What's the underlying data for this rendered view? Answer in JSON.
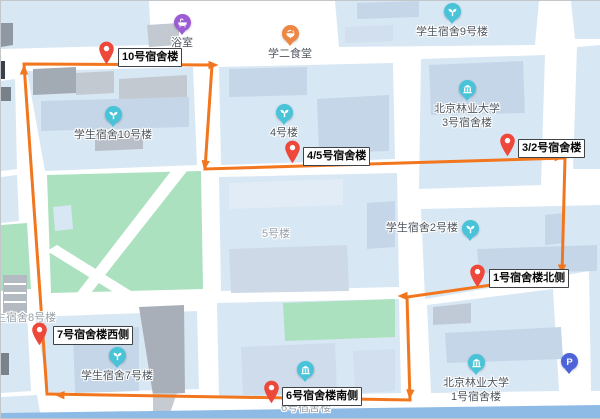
{
  "app": {
    "view": "campus-route-map"
  },
  "colors": {
    "route_orange": "#F2761D",
    "pin_red": "#EE483B",
    "poi_teal": "#49C3D7",
    "poi_purple": "#9C5CD4",
    "poi_orange": "#EE8742",
    "parking_blue": "#4E63D8",
    "block_blue": "#D8E7F4",
    "building_blue": "#C5D6E8",
    "park_green": "#ABE1BF",
    "road_white": "#FFFFFF",
    "label_grey": "#4F565E",
    "muted_grey": "#98A0A9"
  },
  "route": {
    "color": "#F2761D",
    "closed": true,
    "points": [
      [
        23,
        63
      ],
      [
        211,
        64
      ],
      [
        204,
        168
      ],
      [
        564,
        157
      ],
      [
        561,
        274
      ],
      [
        406,
        296
      ],
      [
        409,
        399
      ],
      [
        46,
        393
      ]
    ],
    "arrows": [
      {
        "x": 23,
        "y": 69,
        "deg": -90
      },
      {
        "x": 212,
        "y": 64,
        "deg": 0
      },
      {
        "x": 204,
        "y": 164,
        "deg": 100
      },
      {
        "x": 558,
        "y": 156,
        "deg": -2
      },
      {
        "x": 561,
        "y": 268,
        "deg": 90
      },
      {
        "x": 402,
        "y": 295,
        "deg": 180
      },
      {
        "x": 409,
        "y": 393,
        "deg": 95
      },
      {
        "x": 59,
        "y": 394,
        "deg": 182
      }
    ]
  },
  "waypoints": [
    {
      "label": "10号宿舍楼",
      "tip_x": 105,
      "tip_y": 64,
      "box_x": 117,
      "box_y": 47
    },
    {
      "label": "4/5号宿舍楼",
      "tip_x": 291,
      "tip_y": 163,
      "box_x": 302,
      "box_y": 146
    },
    {
      "label": "3/2号宿舍楼",
      "tip_x": 506,
      "tip_y": 156,
      "box_x": 517,
      "box_y": 138
    },
    {
      "label": "1号宿舍楼北侧",
      "tip_x": 476,
      "tip_y": 287,
      "box_x": 488,
      "box_y": 268
    },
    {
      "label": "6号宿舍楼南侧",
      "tip_x": 270,
      "tip_y": 403,
      "box_x": 281,
      "box_y": 386
    },
    {
      "label": "7号宿舍楼西侧",
      "tip_x": 38,
      "tip_y": 345,
      "box_x": 52,
      "box_y": 325
    }
  ],
  "pois": [
    {
      "id": "bathhouse",
      "icon": "bath-icon",
      "color": "#9C5CD4",
      "x": 181,
      "y": 22,
      "label_pos": "below",
      "lines": [
        "浴室"
      ]
    },
    {
      "id": "canteen-2",
      "icon": "food-icon",
      "color": "#EE8742",
      "x": 289,
      "y": 33,
      "label_pos": "below",
      "lines": [
        "学二食堂"
      ]
    },
    {
      "id": "dorm-9",
      "icon": "sprout-icon",
      "color": "#49C3D7",
      "x": 451,
      "y": 11,
      "label_pos": "below",
      "lines": [
        "学生宿舍9号楼"
      ]
    },
    {
      "id": "bfu-dorm-3",
      "icon": "campus-icon",
      "color": "#49C3D7",
      "x": 466,
      "y": 88,
      "label_pos": "below",
      "lines": [
        "北京林业大学",
        "3号宿舍楼"
      ]
    },
    {
      "id": "dorm-10",
      "icon": "sprout-icon",
      "color": "#49C3D7",
      "x": 112,
      "y": 114,
      "label_pos": "below",
      "lines": [
        "学生宿舍10号楼"
      ]
    },
    {
      "id": "building-4",
      "icon": "sprout-icon",
      "color": "#49C3D7",
      "x": 283,
      "y": 112,
      "label_pos": "below",
      "lines": [
        "4号楼"
      ]
    },
    {
      "id": "dorm-2",
      "icon": "sprout-icon",
      "color": "#49C3D7",
      "x": 469,
      "y": 228,
      "label_pos": "left",
      "lines": [
        "学生宿舍2号楼"
      ]
    },
    {
      "id": "dorm-7",
      "icon": "sprout-icon",
      "color": "#49C3D7",
      "x": 116,
      "y": 355,
      "label_pos": "below",
      "lines": [
        "学生宿舍7号楼"
      ]
    },
    {
      "id": "building-6",
      "icon": "campus-icon",
      "color": "#49C3D7",
      "x": 304,
      "y": 369,
      "label_pos": "none",
      "lines": []
    },
    {
      "id": "bfu-dorm-1",
      "icon": "campus-icon",
      "color": "#49C3D7",
      "x": 475,
      "y": 362,
      "label_pos": "below",
      "lines": [
        "北京林业大学",
        "1号宿舍楼"
      ]
    },
    {
      "id": "parking",
      "icon": "parking-icon",
      "color": "#4E63D8",
      "x": 568,
      "y": 361,
      "label_pos": "none",
      "lines": []
    }
  ],
  "map_texts": [
    {
      "text": "5号楼",
      "x": 275,
      "y": 234,
      "anchor": "center"
    },
    {
      "text": "6号宿舍楼",
      "x": 305,
      "y": 408,
      "anchor": "center"
    },
    {
      "text": "生宿舍8号楼",
      "x": -6,
      "y": 318,
      "anchor": "left"
    }
  ]
}
